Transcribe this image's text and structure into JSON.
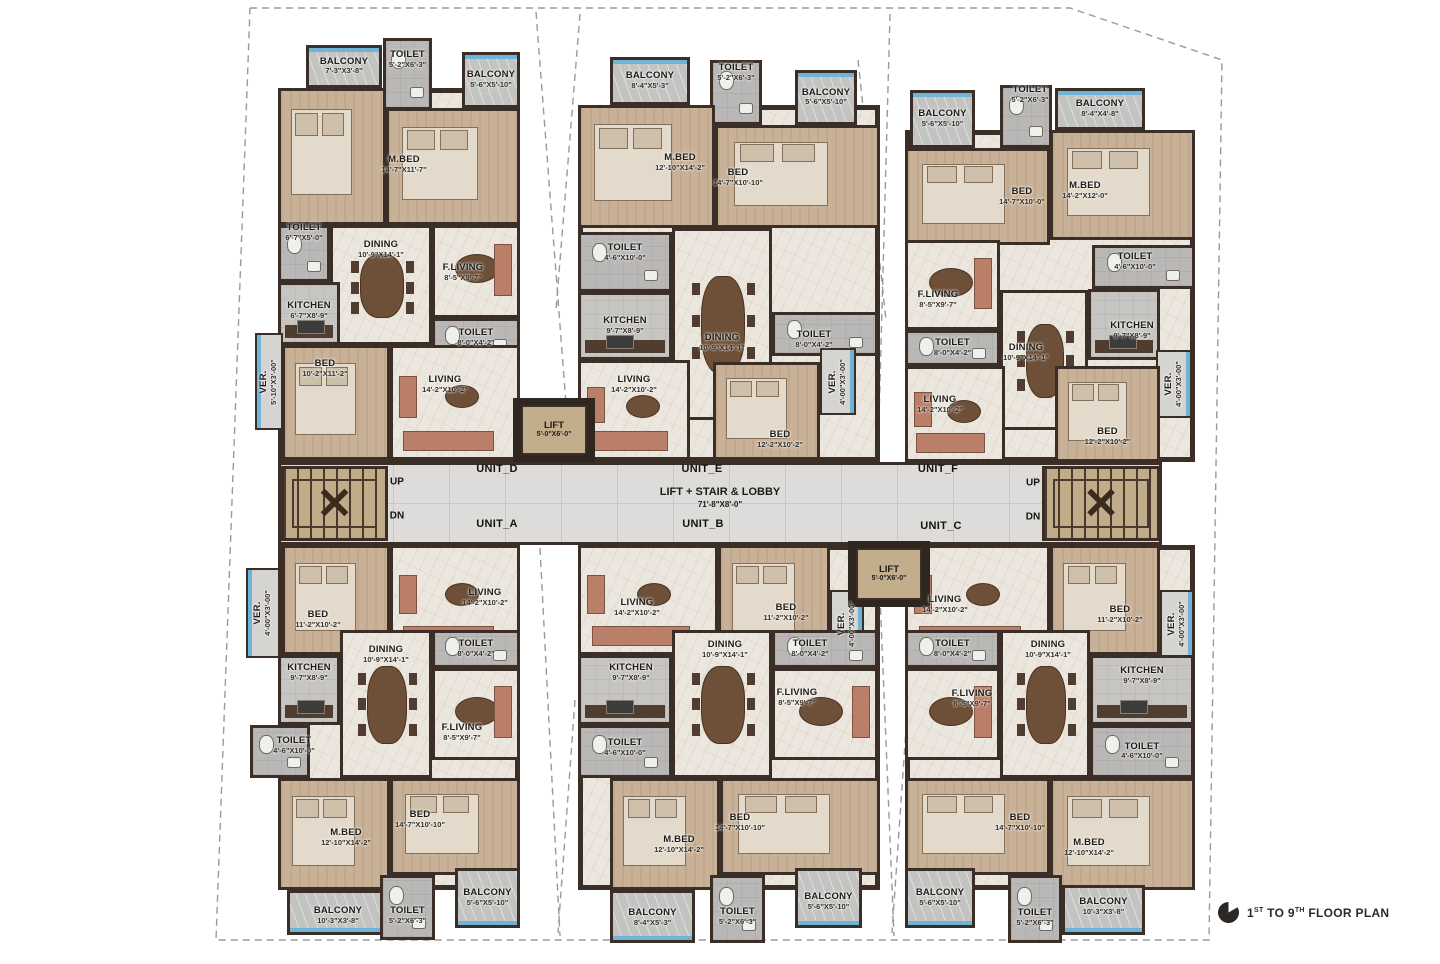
{
  "plan": {
    "footer": {
      "pre": "1",
      "sup1": "ST",
      "mid": " TO 9",
      "sup2": "TH",
      "rest": " FLOOR PLAN"
    }
  },
  "lobby": {
    "label": "LIFT + STAIR & LOBBY",
    "dims": "71'-8\"X8'-0\"",
    "up_label": "UP",
    "dn_label": "DN"
  },
  "lift": {
    "name": "LIFT",
    "dims": "5'-0\"X6'-0\""
  },
  "units": [
    {
      "id": "UNIT_D",
      "rooms": [
        {
          "name": "BALCONY",
          "dims": "7'-3\"X3'-8\""
        },
        {
          "name": "TOILET",
          "dims": "5'-2\"X6'-3\""
        },
        {
          "name": "BALCONY",
          "dims": "5'-6\"X5'-10\""
        },
        {
          "name": "M.BED",
          "dims": "14'-7\"X11'-7\""
        },
        {
          "name": "TOILET",
          "dims": "6'-7\"X5'-0\""
        },
        {
          "name": "DINING",
          "dims": "10'-9\"X14'-1\""
        },
        {
          "name": "F.LIVING",
          "dims": "8'-5\"X9'-7\""
        },
        {
          "name": "KITCHEN",
          "dims": "6'-7\"X8'-9\""
        },
        {
          "name": "TOILET",
          "dims": "8'-0\"X4'-2\""
        },
        {
          "name": "BED",
          "dims": "10'-2\"X11'-2\""
        },
        {
          "name": "VER.",
          "dims": "5'-10\"X3'-00\""
        },
        {
          "name": "LIVING",
          "dims": "14'-2\"X10'-2\""
        }
      ]
    },
    {
      "id": "UNIT_E",
      "rooms": [
        {
          "name": "BALCONY",
          "dims": "8'-4\"X5'-3\""
        },
        {
          "name": "TOILET",
          "dims": "5'-2\"X6'-3\""
        },
        {
          "name": "BALCONY",
          "dims": "5'-6\"X5'-10\""
        },
        {
          "name": "M.BED",
          "dims": "12'-10\"X14'-2\""
        },
        {
          "name": "BED",
          "dims": "14'-7\"X10'-10\""
        },
        {
          "name": "TOILET",
          "dims": "4'-6\"X10'-0\""
        },
        {
          "name": "KITCHEN",
          "dims": "9'-7\"X8'-9\""
        },
        {
          "name": "DINING",
          "dims": "10'-9\"X14'-1\""
        },
        {
          "name": "TOILET",
          "dims": "8'-0\"X4'-2\""
        },
        {
          "name": "LIVING",
          "dims": "14'-2\"X10'-2\""
        },
        {
          "name": "BED",
          "dims": "12'-2\"X10'-2\""
        },
        {
          "name": "VER.",
          "dims": "4'-00\"X3'-00\""
        }
      ]
    },
    {
      "id": "UNIT_F",
      "rooms": [
        {
          "name": "BALCONY",
          "dims": "5'-6\"X5'-10\""
        },
        {
          "name": "TOILET",
          "dims": "5'-2\"X6'-3\""
        },
        {
          "name": "BALCONY",
          "dims": "8'-4\"X4'-8\""
        },
        {
          "name": "BED",
          "dims": "14'-7\"X10'-0\""
        },
        {
          "name": "M.BED",
          "dims": "14'-2\"X12'-0\""
        },
        {
          "name": "TOILET",
          "dims": "4'-6\"X10'-0\""
        },
        {
          "name": "F.LIVING",
          "dims": "8'-5\"X9'-7\""
        },
        {
          "name": "TOILET",
          "dims": "8'-0\"X4'-2\""
        },
        {
          "name": "DINING",
          "dims": "10'-9\"X14'-1\""
        },
        {
          "name": "KITCHEN",
          "dims": "9'-7\"X8'-9\""
        },
        {
          "name": "VER.",
          "dims": "4'-00\"X3'-00\""
        },
        {
          "name": "LIVING",
          "dims": "14'-2\"X10'-2\""
        },
        {
          "name": "BED",
          "dims": "12'-2\"X10'-2\""
        }
      ]
    },
    {
      "id": "UNIT_A",
      "rooms": [
        {
          "name": "BED",
          "dims": "11'-2\"X10'-2\""
        },
        {
          "name": "VER.",
          "dims": "4'-00\"X3'-00\""
        },
        {
          "name": "LIVING",
          "dims": "14'-2\"X10'-2\""
        },
        {
          "name": "KITCHEN",
          "dims": "9'-7\"X8'-9\""
        },
        {
          "name": "DINING",
          "dims": "10'-9\"X14'-1\""
        },
        {
          "name": "TOILET",
          "dims": "8'-0\"X4'-2\""
        },
        {
          "name": "F.LIVING",
          "dims": "8'-5\"X9'-7\""
        },
        {
          "name": "TOILET",
          "dims": "4'-6\"X10'-0\""
        },
        {
          "name": "M.BED",
          "dims": "12'-10\"X14'-2\""
        },
        {
          "name": "BED",
          "dims": "14'-7\"X10'-10\""
        },
        {
          "name": "BALCONY",
          "dims": "10'-3\"X3'-8\""
        },
        {
          "name": "TOILET",
          "dims": "5'-2\"X6'-3\""
        },
        {
          "name": "BALCONY",
          "dims": "5'-6\"X5'-10\""
        }
      ]
    },
    {
      "id": "UNIT_B",
      "rooms": [
        {
          "name": "LIVING",
          "dims": "14'-2\"X10'-2\""
        },
        {
          "name": "BED",
          "dims": "11'-2\"X10'-2\""
        },
        {
          "name": "VER.",
          "dims": "4'-00\"X3'-00\""
        },
        {
          "name": "DINING",
          "dims": "10'-9\"X14'-1\""
        },
        {
          "name": "TOILET",
          "dims": "8'-0\"X4'-2\""
        },
        {
          "name": "KITCHEN",
          "dims": "9'-7\"X8'-9\""
        },
        {
          "name": "F.LIVING",
          "dims": "8'-5\"X9'-7\""
        },
        {
          "name": "TOILET",
          "dims": "4'-6\"X10'-0\""
        },
        {
          "name": "M.BED",
          "dims": "12'-10\"X14'-2\""
        },
        {
          "name": "BED",
          "dims": "14'-7\"X10'-10\""
        },
        {
          "name": "BALCONY",
          "dims": "8'-4\"X5'-3\""
        },
        {
          "name": "TOILET",
          "dims": "5'-2\"X6'-3\""
        },
        {
          "name": "BALCONY",
          "dims": "5'-6\"X5'-10\""
        }
      ]
    },
    {
      "id": "UNIT_C",
      "rooms": [
        {
          "name": "LIVING",
          "dims": "14'-2\"X10'-2\""
        },
        {
          "name": "BED",
          "dims": "11'-2\"X10'-2\""
        },
        {
          "name": "VER.",
          "dims": "4'-00\"X3'-00\""
        },
        {
          "name": "TOILET",
          "dims": "8'-0\"X4'-2\""
        },
        {
          "name": "DINING",
          "dims": "10'-9\"X14'-1\""
        },
        {
          "name": "KITCHEN",
          "dims": "9'-7\"X8'-9\""
        },
        {
          "name": "F.LIVING",
          "dims": "8'-5\"X9'-7\""
        },
        {
          "name": "TOILET",
          "dims": "4'-6\"X10'-0\""
        },
        {
          "name": "BED",
          "dims": "14'-7\"X10'-10\""
        },
        {
          "name": "M.BED",
          "dims": "12'-10\"X14'-2\""
        },
        {
          "name": "BALCONY",
          "dims": "5'-6\"X5'-10\""
        },
        {
          "name": "TOILET",
          "dims": "5'-2\"X6'-3\""
        },
        {
          "name": "BALCONY",
          "dims": "10'-3\"X3'-8\""
        }
      ]
    }
  ]
}
